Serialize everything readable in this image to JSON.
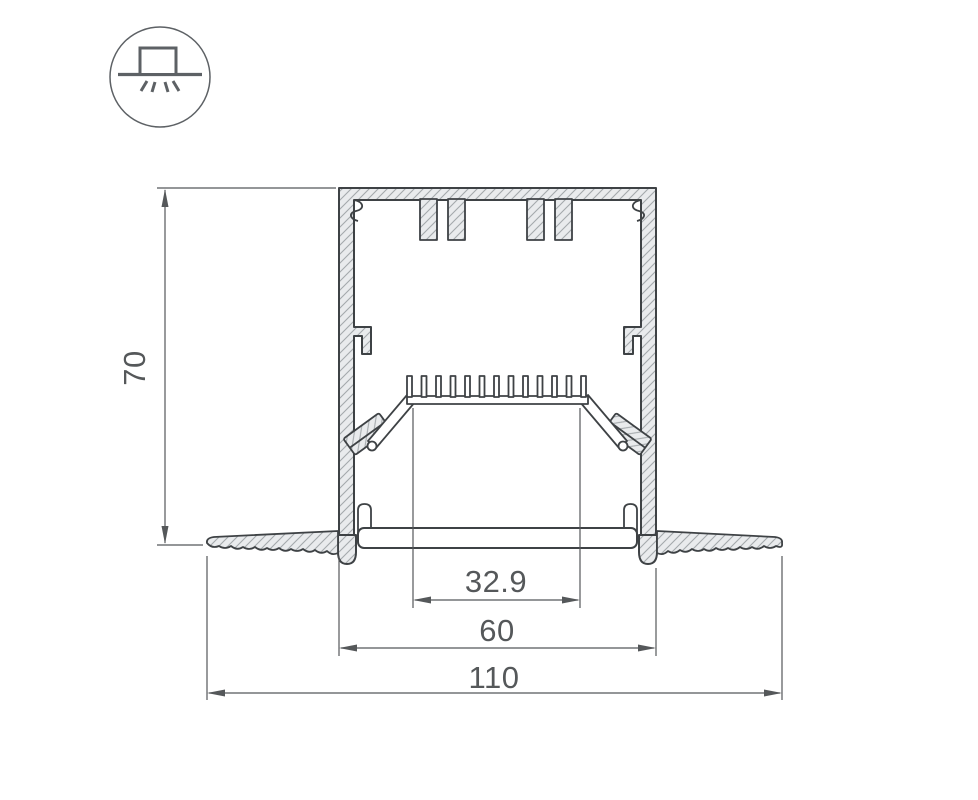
{
  "icon": {
    "name": "recessed-mount-light-icon",
    "description": "circle badge with a luminaire box on a ceiling line emitting light rays downward"
  },
  "drawing": {
    "title": "LED profile cross-section",
    "dimensions": {
      "height": "70",
      "led_platform_width": "32.9",
      "body_width": "60",
      "overall_width": "110"
    }
  },
  "colors": {
    "background": "#ffffff",
    "outline": "#3e4245",
    "dimension_line": "#55585a",
    "hatch_fill": "#e9ebed",
    "hatch_line": "#a4a9ac",
    "icon_stroke": "#5d6165"
  }
}
